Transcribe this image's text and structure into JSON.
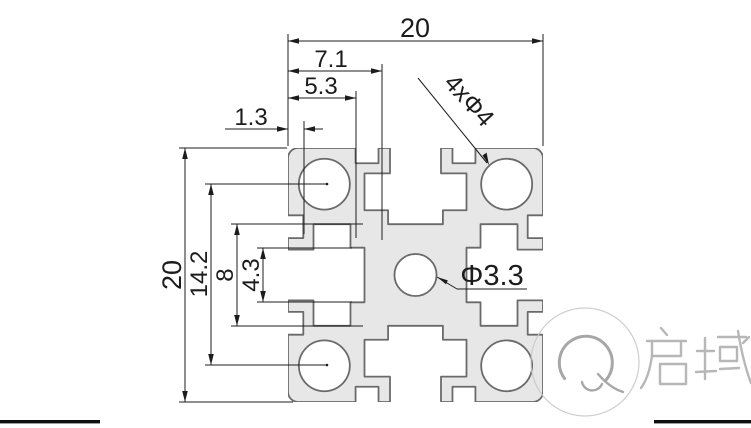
{
  "drawing_type": "aluminium-profile-cross-section",
  "colors": {
    "background": "#ffffff",
    "profile_fill": "#e7e7e7",
    "profile_stroke": "#6a6a6a",
    "dimension_color": "#1c1c1c",
    "watermark_color": "#adadad",
    "bottom_bar_color": "#101010"
  },
  "dimensions": {
    "top_overall_width": {
      "label": "20"
    },
    "slot_lip_offset": {
      "label": "7.1"
    },
    "mouth_notch_offset": {
      "label": "5.3"
    },
    "lip_thickness": {
      "label": "1.3"
    },
    "left_overall_height": {
      "label": "20"
    },
    "hole_spacing": {
      "label": "14.2"
    },
    "core_size": {
      "label": "8"
    },
    "slot_neck_width": {
      "label": "4.3"
    }
  },
  "callouts": {
    "corner_holes": {
      "label": "4xΦ4"
    },
    "center_hole": {
      "label": "Φ3.3"
    }
  },
  "watermark": {
    "text": "启域"
  }
}
